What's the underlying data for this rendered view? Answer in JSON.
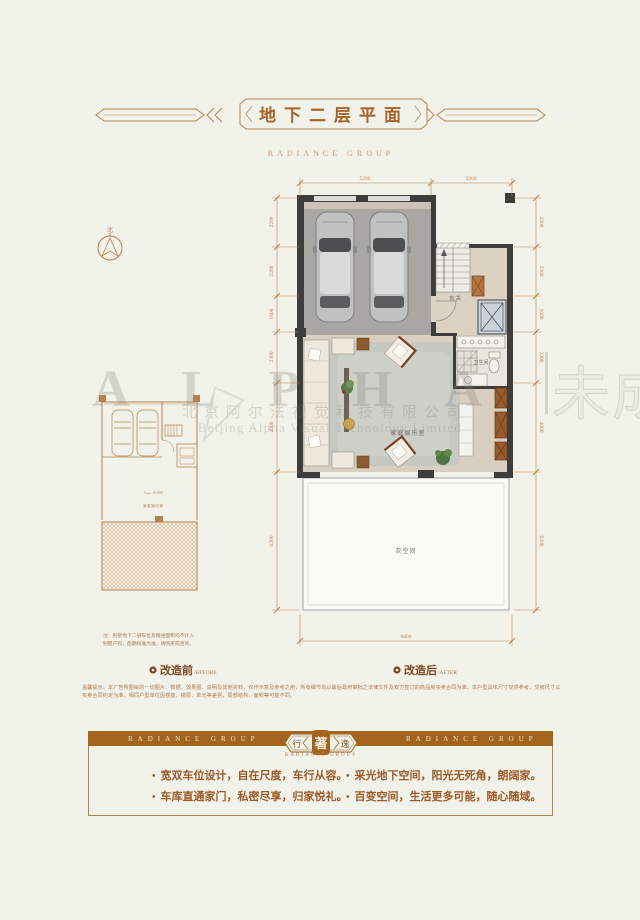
{
  "header": {
    "title": "地下二层平面",
    "subtitle": "RADIANCE GROUP"
  },
  "compass": {
    "north_label": "北"
  },
  "floorplan": {
    "rooms": {
      "entry": "玄关",
      "bath": "卫生间",
      "family": "家庭娱乐室",
      "gray": "灰空间"
    },
    "dims": {
      "top": [
        "5200",
        "3200"
      ],
      "bottom": "8400",
      "left": [
        "2200",
        "2200",
        "1600",
        "2300",
        "4000",
        "6200"
      ],
      "right": [
        "2200",
        "2200",
        "1600",
        "2300",
        "4000",
        "6200"
      ]
    },
    "before_plan": {
      "elevation": "-8.000",
      "room_label": "家庭娱乐室"
    },
    "note_line1": "注：别墅地下二层车位及赠送面积均不计入",
    "note_line2": "别墅产权，后期核准为准，请购买前咨询。"
  },
  "watermark": {
    "brand": "ALPHA",
    "company_cn": "北京阿尔法视觉科技有限公司",
    "company_en": "Beijing Alpha Visual Technology Limited",
    "status": "未成品"
  },
  "legend": {
    "before": {
      "label": "改造前",
      "sub": "/BEFORE"
    },
    "after": {
      "label": "改造后",
      "sub": "/AFTER"
    }
  },
  "disclaimer": {
    "line1": "温馨提示：本广告所图绘的一切图片、数据、效果图、说明及其他资料，仅作示意及参考之用，所有细节均以最后政府审批之法律文件及双方签订的商品房买卖合同为准。本户型具体尺寸仅供参考，交房尺寸以",
    "line2": "买卖合同约定为准。相同户型单位因楼座、楼层、单元等差别，局部结构、面积等可能不同。"
  },
  "footer": {
    "band_left": "RADIANCE GROUP",
    "band_right": "RADIANCE GROUP",
    "badge": {
      "left": "行",
      "center": "著",
      "right": "逸",
      "sub": "RADIANCE GROUP"
    },
    "bullets": [
      "宽双车位设计，自在尺度，车行从容。",
      "采光地下空间，阳光无死角，朗阔家。",
      "车库直通家门，私密尽享，归家悦礼。",
      "百变空间，生活更多可能，随心随域。"
    ]
  },
  "colors": {
    "accent_brown": "#a4641e",
    "dim_orange": "#bf8350",
    "wall_dark": "#3d3d3b",
    "background": "#f1f2e9"
  }
}
